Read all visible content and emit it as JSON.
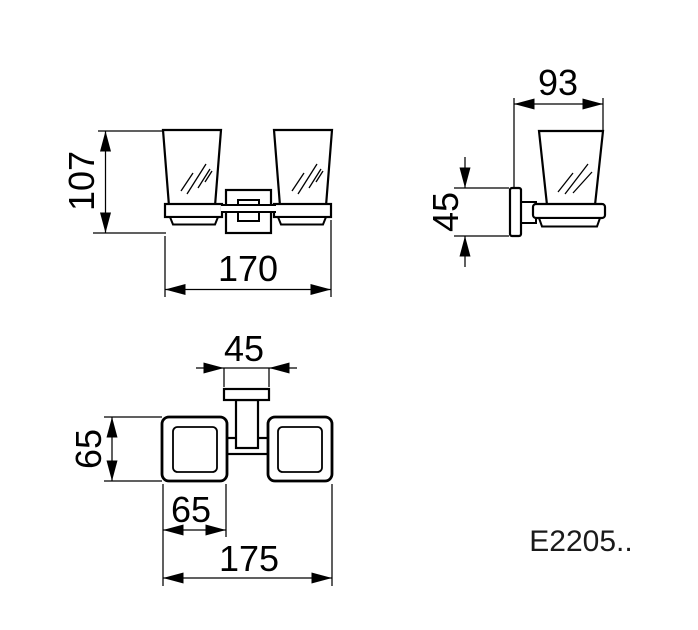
{
  "product": {
    "code": "E2205.."
  },
  "dimensions": {
    "front_height": "107",
    "front_width": "170",
    "side_depth": "93",
    "side_bracket_height": "45",
    "plan_bracket_width": "45",
    "plan_holder_depth": "65",
    "plan_holder_width": "65",
    "plan_total_width": "175"
  }
}
